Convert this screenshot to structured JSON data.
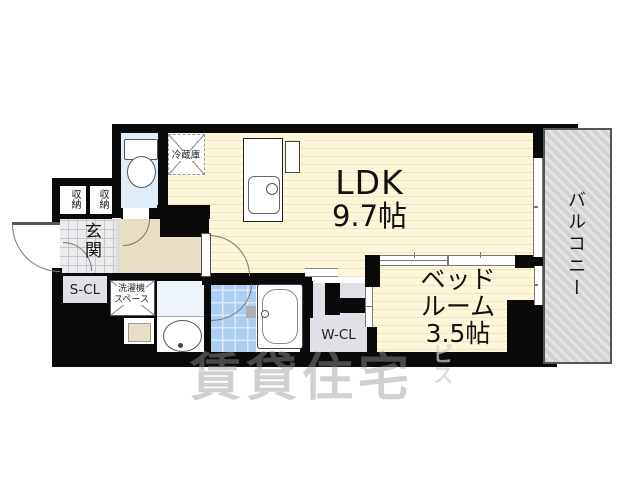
{
  "rooms": {
    "ldk": {
      "name": "LDK",
      "size": "9.7帖"
    },
    "bedroom": {
      "name_line1": "ベッド",
      "name_line2": "ルーム",
      "size": "3.5帖"
    },
    "balcony": {
      "label": "バルコニー"
    },
    "entrance": {
      "label": "玄関"
    },
    "storage_left": {
      "label": "収納"
    },
    "storage_right": {
      "label": "収納"
    },
    "shoe_closet": {
      "label": "S-CL"
    },
    "walk_in_closet": {
      "label": "W-CL"
    },
    "refrigerator": {
      "label": "冷蔵庫"
    },
    "laundry": {
      "line1": "洗濯機",
      "line2": "スペース"
    }
  },
  "watermark": {
    "main": "賃貸住宅",
    "sub": "ビス"
  },
  "colors": {
    "wall": "#0a0a0a",
    "tatami_floor": "#FCF6DB",
    "tatami_stripe": "#F1E5BD",
    "corridor_floor": "#E8DEC5",
    "genkan_tile": "#EBEBEE",
    "toilet_floor": "#DEEDF8",
    "washroom_floor": "#ECF3F9",
    "bath_tile": "#ABCFF0",
    "closet_fill": "#E2E0E6",
    "balcony_fill": "#D2D2D2"
  }
}
